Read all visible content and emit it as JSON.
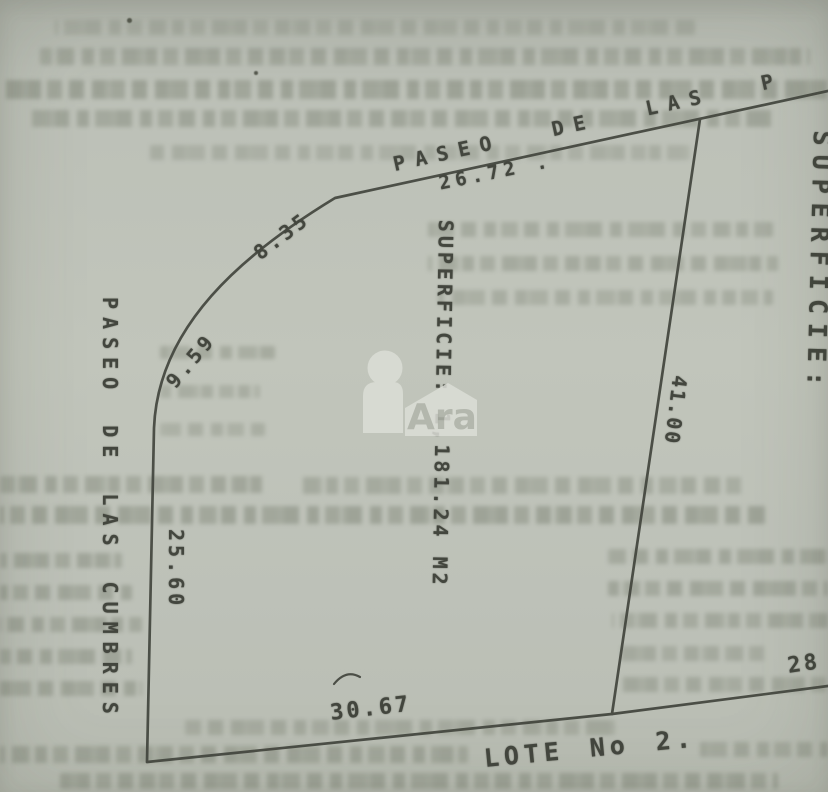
{
  "plan": {
    "streets": {
      "top": "PASEO DE LAS P",
      "left": "PASEO DE LAS CUMBRES"
    },
    "lot": {
      "label": "LOTE No 2."
    },
    "areas": {
      "center": "SUPERFICIE: 1,181.24 M2",
      "right_clipped": "SUPERFICIE:"
    },
    "dimensions": {
      "top": "26.72 .",
      "curve_upper": "8.35",
      "curve_lower": "9.59",
      "left": "25.60",
      "interior": "41.00",
      "bottom": "30.67",
      "right_partial": "28"
    },
    "watermark": {
      "text": "Ara"
    }
  },
  "colors": {
    "paper": "#bdc1b8",
    "ink": "#43463e",
    "bleed_text": "#868c7e",
    "watermark_shape": "#dcded7",
    "watermark_text": "#afb3a9"
  }
}
